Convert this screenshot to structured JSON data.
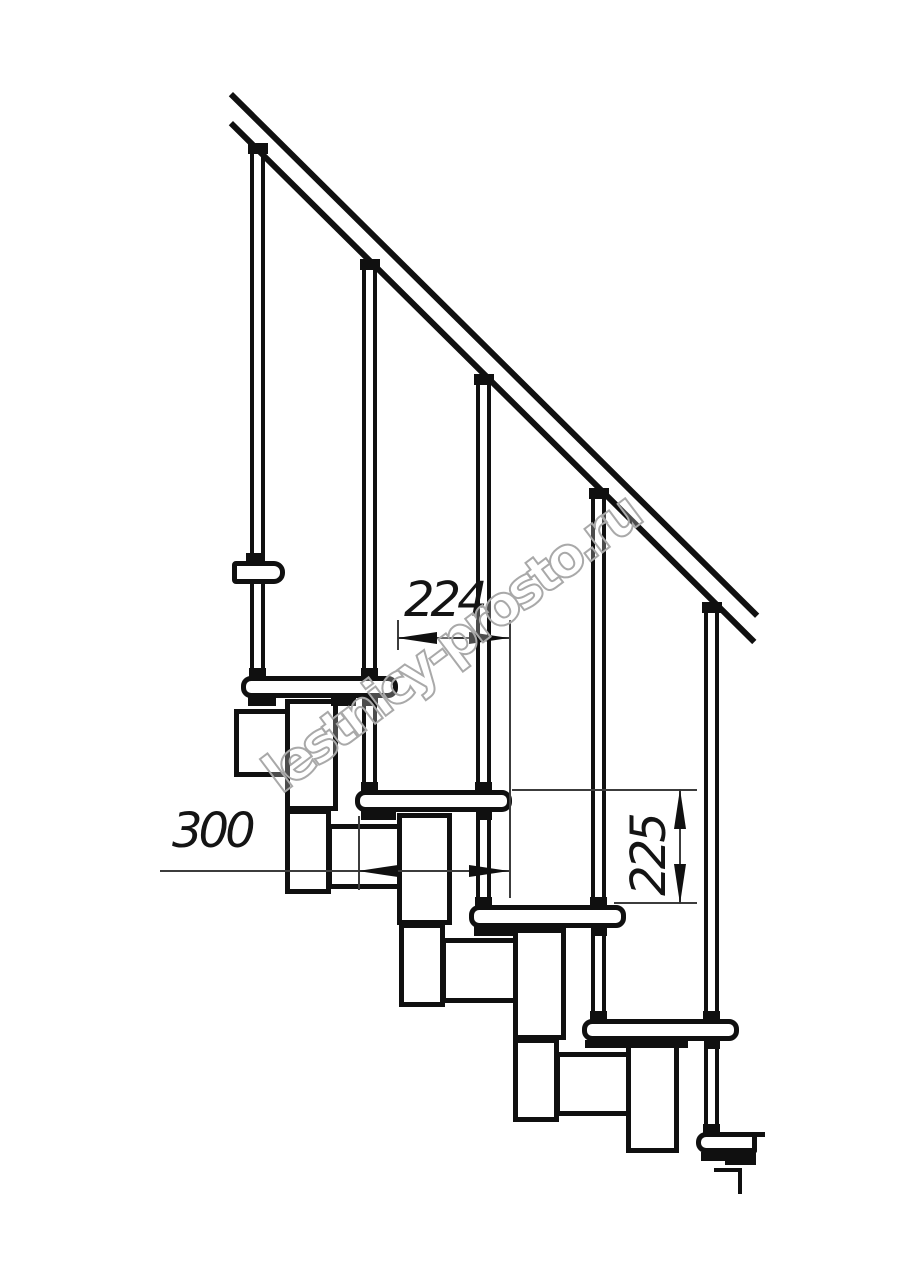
{
  "page": {
    "width": 914,
    "height": 1280,
    "background": "#ffffff"
  },
  "drawing": {
    "ink_color": "#101010",
    "thin_line_color": "#3c3c3c",
    "dimensions": {
      "d224": {
        "label": "224"
      },
      "d300": {
        "label": "300"
      },
      "d225": {
        "label": "225"
      }
    },
    "watermark": {
      "text": "lestnicy-prosto.ru",
      "stroke_color": "#a9a9a9",
      "angle_deg": -37
    },
    "shapes": [
      {
        "name": "baluster-1",
        "cls": "post",
        "x": 250,
        "y": 153,
        "w": 15,
        "h": 527
      },
      {
        "name": "baluster-2",
        "cls": "post",
        "x": 362,
        "y": 270,
        "w": 15,
        "h": 525
      },
      {
        "name": "baluster-3",
        "cls": "post",
        "x": 476,
        "y": 384,
        "w": 15,
        "h": 526
      },
      {
        "name": "baluster-4",
        "cls": "post",
        "x": 591,
        "y": 499,
        "w": 15,
        "h": 526
      },
      {
        "name": "baluster-5",
        "cls": "post",
        "x": 704,
        "y": 612,
        "w": 15,
        "h": 526
      },
      {
        "name": "wall-mount-box",
        "cls": "outline",
        "x": 234,
        "y": 709,
        "w": 57,
        "h": 68
      },
      {
        "name": "module-2-upper-box",
        "cls": "outline",
        "x": 285,
        "y": 699,
        "w": 53,
        "h": 112
      },
      {
        "name": "module-2-lower-box",
        "cls": "outline",
        "x": 285,
        "y": 809,
        "w": 46,
        "h": 85
      },
      {
        "name": "module-2-seat-box",
        "cls": "outline",
        "x": 327,
        "y": 824,
        "w": 79,
        "h": 65
      },
      {
        "name": "module-3-upper-box",
        "cls": "outline",
        "x": 397,
        "y": 813,
        "w": 55,
        "h": 112
      },
      {
        "name": "module-3-lower-box",
        "cls": "outline",
        "x": 399,
        "y": 923,
        "w": 46,
        "h": 84
      },
      {
        "name": "module-3-seat-box",
        "cls": "outline",
        "x": 441,
        "y": 938,
        "w": 79,
        "h": 65
      },
      {
        "name": "module-4-upper-box",
        "cls": "outline",
        "x": 513,
        "y": 928,
        "w": 53,
        "h": 112
      },
      {
        "name": "module-4-lower-box",
        "cls": "outline",
        "x": 513,
        "y": 1038,
        "w": 46,
        "h": 84
      },
      {
        "name": "module-4-seat-box",
        "cls": "outline",
        "x": 555,
        "y": 1052,
        "w": 80,
        "h": 64
      },
      {
        "name": "module-5-upper-box",
        "cls": "outline",
        "x": 626,
        "y": 1042,
        "w": 53,
        "h": 111
      },
      {
        "name": "floor-cut-line-horizontal",
        "cls": "fill",
        "x": 714,
        "y": 1168,
        "w": 28,
        "h": 4
      },
      {
        "name": "floor-cut-line-vertical",
        "cls": "fill",
        "x": 738,
        "y": 1168,
        "w": 4,
        "h": 26
      },
      {
        "name": "tread-2",
        "cls": "outline",
        "x": 241,
        "y": 676,
        "w": 157,
        "h": 22,
        "r": "10px"
      },
      {
        "name": "tread-3",
        "cls": "outline",
        "x": 355,
        "y": 790,
        "w": 157,
        "h": 22,
        "r": "10px"
      },
      {
        "name": "tread-4",
        "cls": "outline",
        "x": 469,
        "y": 905,
        "w": 157,
        "h": 23,
        "r": "10px"
      },
      {
        "name": "tread-5",
        "cls": "outline",
        "x": 582,
        "y": 1019,
        "w": 157,
        "h": 22,
        "r": "10px"
      },
      {
        "name": "tread-6-partial",
        "cls": "outline",
        "x": 696,
        "y": 1132,
        "w": 61,
        "h": 21,
        "r": "10px 2px 2px 10px"
      },
      {
        "name": "tread-6-edge-stub",
        "cls": "fill",
        "x": 751,
        "y": 1132,
        "w": 14,
        "h": 5
      },
      {
        "name": "upper-rail-bracket",
        "cls": "outline",
        "x": 232,
        "y": 561,
        "w": 53,
        "h": 23,
        "r": "4px 11px 11px 4px"
      },
      {
        "name": "mount-plate-tread-2-left",
        "cls": "fill",
        "x": 248,
        "y": 697,
        "w": 28,
        "h": 9
      },
      {
        "name": "mount-plate-tread-2-right",
        "cls": "fill",
        "x": 331,
        "y": 697,
        "w": 25,
        "h": 9
      },
      {
        "name": "mount-plate-tread-3",
        "cls": "fill",
        "x": 361,
        "y": 811,
        "w": 35,
        "h": 9
      },
      {
        "name": "mount-plate-tread-4",
        "cls": "fill",
        "x": 474,
        "y": 926,
        "w": 43,
        "h": 10
      },
      {
        "name": "mount-plate-tread-5",
        "cls": "fill",
        "x": 585,
        "y": 1040,
        "w": 103,
        "h": 8
      },
      {
        "name": "mount-plate-tread-6",
        "cls": "fill",
        "x": 701,
        "y": 1152,
        "w": 55,
        "h": 9
      },
      {
        "name": "mount-plate-tread-6-step",
        "cls": "fill",
        "x": 725,
        "y": 1158,
        "w": 31,
        "h": 7
      },
      {
        "name": "collar-bracket-baluster-1",
        "cls": "fill",
        "x": 246,
        "y": 553,
        "w": 17,
        "h": 9
      },
      {
        "name": "collar-tread-2-baluster-1",
        "cls": "fill",
        "x": 249,
        "y": 668,
        "w": 17,
        "h": 9
      },
      {
        "name": "collar-tread-2-baluster-2",
        "cls": "fill",
        "x": 361,
        "y": 668,
        "w": 17,
        "h": 9
      },
      {
        "name": "collar-tread-3-baluster-2",
        "cls": "fill",
        "x": 361,
        "y": 782,
        "w": 17,
        "h": 9
      },
      {
        "name": "collar-tread-3-baluster-3",
        "cls": "fill",
        "x": 475,
        "y": 782,
        "w": 17,
        "h": 9
      },
      {
        "name": "collar-tread-4-baluster-3",
        "cls": "fill",
        "x": 475,
        "y": 897,
        "w": 17,
        "h": 9
      },
      {
        "name": "collar-tread-4-baluster-4",
        "cls": "fill",
        "x": 590,
        "y": 897,
        "w": 17,
        "h": 9
      },
      {
        "name": "collar-tread-5-baluster-4",
        "cls": "fill",
        "x": 590,
        "y": 1011,
        "w": 17,
        "h": 9
      },
      {
        "name": "collar-tread-5-baluster-5",
        "cls": "fill",
        "x": 703,
        "y": 1011,
        "w": 17,
        "h": 9
      },
      {
        "name": "collar-tread-6-baluster-5",
        "cls": "fill",
        "x": 703,
        "y": 1124,
        "w": 17,
        "h": 9
      },
      {
        "name": "collar-under-tread-2-baluster-2",
        "cls": "fill",
        "x": 362,
        "y": 698,
        "w": 16,
        "h": 8
      },
      {
        "name": "collar-under-tread-3-baluster-3",
        "cls": "fill",
        "x": 476,
        "y": 812,
        "w": 16,
        "h": 8
      },
      {
        "name": "collar-under-tread-4-baluster-4",
        "cls": "fill",
        "x": 591,
        "y": 928,
        "w": 16,
        "h": 8
      },
      {
        "name": "collar-under-tread-5-baluster-5",
        "cls": "fill",
        "x": 704,
        "y": 1041,
        "w": 16,
        "h": 8
      },
      {
        "name": "handrail-top-line",
        "cls": "fill",
        "x": 233,
        "y": 92,
        "w": 741,
        "h": 6,
        "rot": 44.75
      },
      {
        "name": "handrail-bottom-line",
        "cls": "fill",
        "x": 233,
        "y": 121,
        "w": 737,
        "h": 6,
        "rot": 44.75
      },
      {
        "name": "baluster-cap-1",
        "cls": "fill",
        "x": 248,
        "y": 143,
        "w": 20,
        "h": 11
      },
      {
        "name": "baluster-cap-2",
        "cls": "fill",
        "x": 360,
        "y": 259,
        "w": 20,
        "h": 11
      },
      {
        "name": "baluster-cap-3",
        "cls": "fill",
        "x": 474,
        "y": 374,
        "w": 20,
        "h": 11
      },
      {
        "name": "baluster-cap-4",
        "cls": "fill",
        "x": 589,
        "y": 488,
        "w": 20,
        "h": 11
      },
      {
        "name": "baluster-cap-5",
        "cls": "fill",
        "x": 702,
        "y": 602,
        "w": 20,
        "h": 11
      },
      {
        "name": "extension-line-224-left",
        "cls": "thin",
        "x": 397,
        "y": 620,
        "w": 2,
        "h": 30
      },
      {
        "name": "extension-line-right-shared",
        "cls": "thin",
        "x": 509,
        "y": 620,
        "w": 2,
        "h": 278
      },
      {
        "name": "dimension-line-224",
        "cls": "thin",
        "x": 397,
        "y": 637,
        "w": 114,
        "h": 2
      },
      {
        "name": "dimension-line-300",
        "cls": "thin",
        "x": 160,
        "y": 870,
        "w": 351,
        "h": 2
      },
      {
        "name": "extension-line-300-left",
        "cls": "thin",
        "x": 358,
        "y": 816,
        "w": 2,
        "h": 74
      },
      {
        "name": "extension-line-225-top",
        "cls": "thin",
        "x": 512,
        "y": 789,
        "w": 185,
        "h": 2
      },
      {
        "name": "extension-line-225-bottom",
        "cls": "thin",
        "x": 614,
        "y": 902,
        "w": 83,
        "h": 2
      },
      {
        "name": "dimension-line-225",
        "cls": "thin",
        "x": 679,
        "y": 789,
        "w": 2,
        "h": 115
      },
      {
        "name": "arrowhead-224-left",
        "cls": "arrow-left",
        "x": 397,
        "y": 632
      },
      {
        "name": "arrowhead-224-right",
        "cls": "arrow-right",
        "x": 469,
        "y": 632
      },
      {
        "name": "arrowhead-300-left",
        "cls": "arrow-left",
        "x": 358,
        "y": 865
      },
      {
        "name": "arrowhead-300-right",
        "cls": "arrow-right",
        "x": 469,
        "y": 865
      },
      {
        "name": "arrowhead-225-up",
        "cls": "arrow-up",
        "x": 674,
        "y": 789
      },
      {
        "name": "arrowhead-225-down",
        "cls": "arrow-down",
        "x": 674,
        "y": 864
      }
    ]
  }
}
